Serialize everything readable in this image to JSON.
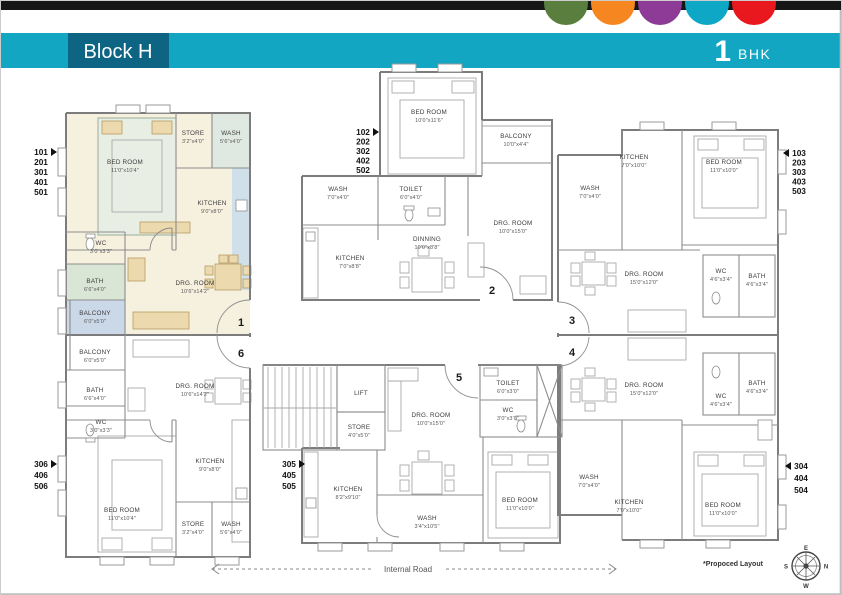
{
  "header": {
    "block_label": "Block H",
    "bhk_number": "1",
    "bhk_label": "BHK"
  },
  "brand_dots": [
    "#5a7e3e",
    "#f6861f",
    "#8d3b96",
    "#0fa7c6",
    "#e9181f"
  ],
  "palette": {
    "top_bar": "#161616",
    "header_teal": "#12a6c2",
    "header_box": "#0d6583",
    "highlight_cream": "#f6f1df",
    "balcony_blue": "#cbd8e8",
    "bath_green": "#d9e5d5",
    "kitchen_blue": "#cfe0ea",
    "furniture_tan": "#ecd9ae",
    "wall_gray": "#7c7c7c"
  },
  "unit_stacks": {
    "left_top": {
      "labels": [
        "101",
        "201",
        "301",
        "401",
        "501"
      ]
    },
    "left_bottom": {
      "labels": [
        "306",
        "406",
        "506"
      ]
    },
    "mid_top": {
      "labels": [
        "102",
        "202",
        "302",
        "402",
        "502"
      ]
    },
    "mid_bottom": {
      "labels": [
        "305",
        "405",
        "505"
      ]
    },
    "right_top": {
      "labels": [
        "103",
        "203",
        "303",
        "403",
        "503"
      ]
    },
    "right_bottom": {
      "labels": [
        "304",
        "404",
        "504"
      ]
    }
  },
  "doors": {
    "d1": "1",
    "d2": "2",
    "d3": "3",
    "d4": "4",
    "d5": "5",
    "d6": "6"
  },
  "units": {
    "u1": {
      "bedroom": {
        "name": "BED ROOM",
        "dims": "11'0\"x10'4\""
      },
      "store": {
        "name": "STORE",
        "dims": "3'2\"x4'0\""
      },
      "wash": {
        "name": "WASH",
        "dims": "5'6\"x4'0\""
      },
      "kitchen": {
        "name": "KITCHEN",
        "dims": "9'0\"x8'0\""
      },
      "wc": {
        "name": "WC",
        "dims": "3'0\"x3'3\""
      },
      "bath": {
        "name": "BATH",
        "dims": "6'6\"x4'0\""
      },
      "balcony": {
        "name": "BALCONY",
        "dims": "6'0\"x5'0\""
      },
      "drg": {
        "name": "DRG. ROOM",
        "dims": "10'6\"x14'2\""
      }
    },
    "u2": {
      "bedroom": {
        "name": "BED ROOM",
        "dims": "10'0\"x11'6\""
      },
      "wash": {
        "name": "WASH",
        "dims": "7'0\"x4'0\""
      },
      "toilet": {
        "name": "TOILET",
        "dims": "6'0\"x4'0\""
      },
      "kitchen": {
        "name": "KITCHEN",
        "dims": "7'0\"x8'8\""
      },
      "dinning": {
        "name": "DINNING",
        "dims": "10'0\"x8'8\""
      },
      "balcony": {
        "name": "BALCONY",
        "dims": "10'0\"x4'4\""
      },
      "drg": {
        "name": "DRG. ROOM",
        "dims": "10'0\"x15'0\""
      }
    },
    "u3": {
      "wash": {
        "name": "WASH",
        "dims": "7'0\"x4'0\""
      },
      "kitchen": {
        "name": "KITCHEN",
        "dims": "7'0\"x10'0\""
      },
      "bedroom": {
        "name": "BED ROOM",
        "dims": "11'0\"x10'0\""
      },
      "drg": {
        "name": "DRG. ROOM",
        "dims": "15'0\"x12'0\""
      },
      "wc": {
        "name": "WC",
        "dims": "4'6\"x3'4\""
      },
      "bath": {
        "name": "BATH",
        "dims": "4'6\"x3'4\""
      }
    },
    "u4": {
      "drg": {
        "name": "DRG. ROOM",
        "dims": "15'0\"x12'0\""
      },
      "wc": {
        "name": "WC",
        "dims": "4'6\"x3'4\""
      },
      "bath": {
        "name": "BATH",
        "dims": "4'6\"x3'4\""
      },
      "wash": {
        "name": "WASH",
        "dims": "7'0\"x4'0\""
      },
      "kitchen": {
        "name": "KITCHEN",
        "dims": "7'0\"x10'0\""
      },
      "bedroom": {
        "name": "BED ROOM",
        "dims": "11'0\"x10'0\""
      }
    },
    "u5": {
      "lift": {
        "name": "LIFT"
      },
      "store": {
        "name": "STORE",
        "dims": "4'0\"x5'0\""
      },
      "drg": {
        "name": "DRG. ROOM",
        "dims": "10'0\"x15'0\""
      },
      "toilet": {
        "name": "TOILET",
        "dims": "6'0\"x3'0\""
      },
      "wc": {
        "name": "WC",
        "dims": "3'0\"x3'0\""
      },
      "kitchen": {
        "name": "KITCHEN",
        "dims": "8'2\"x9'10\""
      },
      "wash": {
        "name": "WASH",
        "dims": "3'4\"x10'5\""
      },
      "bedroom": {
        "name": "BED ROOM",
        "dims": "11'0\"x10'0\""
      }
    },
    "u6": {
      "balcony": {
        "name": "BALCONY",
        "dims": "6'0\"x5'0\""
      },
      "bath": {
        "name": "BATH",
        "dims": "6'6\"x4'0\""
      },
      "wc": {
        "name": "WC",
        "dims": "3'0\"x3'3\""
      },
      "drg": {
        "name": "DRG. ROOM",
        "dims": "10'6\"x14'2\""
      },
      "bedroom": {
        "name": "BED ROOM",
        "dims": "11'0\"x10'4\""
      },
      "kitchen": {
        "name": "KITCHEN",
        "dims": "9'0\"x8'0\""
      },
      "store": {
        "name": "STORE",
        "dims": "3'2\"x4'0\""
      },
      "wash": {
        "name": "WASH",
        "dims": "5'6\"x4'0\""
      }
    }
  },
  "footer": {
    "internal_road": "Internal Road",
    "note": "*Propoced Layout"
  },
  "compass": {
    "top": "E",
    "right": "N",
    "left": "S",
    "bottom": "W"
  }
}
